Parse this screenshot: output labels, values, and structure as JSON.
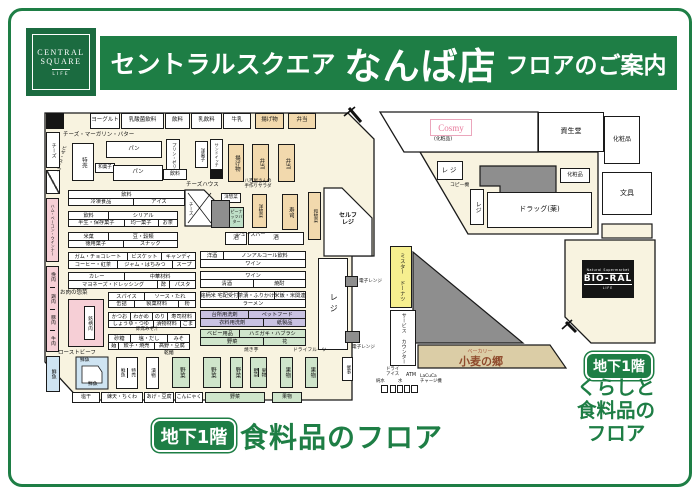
{
  "colors": {
    "brand_green": "#1e7e45",
    "floor_beige": "#f8f3e0",
    "deli_tan": "#f2d9ad",
    "meat_pink": "#f6cfd6",
    "fish_blue": "#cfe4f2",
    "produce_green": "#cfe5cb",
    "daily_purple": "#c9c2e2",
    "donut_yellow": "#f6ef8f"
  },
  "header": {
    "logo": {
      "line1": "CENTRAL",
      "line2": "SQUARE",
      "line3": "LIFE"
    },
    "title_store": "セントラルスクエア",
    "title_name": "なんば店",
    "title_suffix": "フロアのご案内"
  },
  "map": {
    "top_wall": [
      "ヨーグルト",
      "乳酸菌飲料",
      "飲料",
      "乳飲料",
      "牛乳",
      "揚げ物",
      "弁当"
    ],
    "dairy_label": "チーズ・マーガリン・バター",
    "left_wall": {
      "cheese": "チーズ",
      "pizza_soup": "ピザ・スープ",
      "ham": "ハム・ベーコン・ウインナー",
      "meat": [
        "挽肉",
        "鶏肉",
        "豚肉",
        "牛肉"
      ],
      "fish": "鮮魚"
    },
    "upper": {
      "tokubai": "特売",
      "pan1": "パン",
      "wagashi": "和菓子",
      "pan2": "パン",
      "purin": "プリン・ゼリー",
      "drink": "飲料",
      "yogashi": "洋菓子",
      "sandwich": "サンドイッチ",
      "agemono": "揚げ物",
      "bento1": "弁当",
      "bento2": "弁当"
    },
    "deli": {
      "cheese_house": "チーズハウス",
      "cheese": "チーズ",
      "salad": "八百屋さんの\n手作りサラダ",
      "yososai_small": "洋惣菜",
      "peanut": "ピーナッツバター",
      "juice_bar": "ジュースバー",
      "yososai": "洋惣菜",
      "sushi": "寿司",
      "wasozai": "和惣菜",
      "sake1": "酒",
      "sake2": "酒",
      "self_checkout": "セルフ\nレジ"
    },
    "shelves": [
      {
        "top": [
          "飲料"
        ],
        "bottom": [
          "冷凍食品",
          "アイス"
        ]
      },
      {
        "top": [
          "飲料",
          "シリアル"
        ],
        "bottom": [
          "半生・保存菓子",
          "均一菓子",
          "お茶"
        ]
      },
      {
        "top": [
          "米菓",
          "豆・穀類"
        ],
        "bottom": [
          "徳用菓子",
          "スナック"
        ]
      },
      {
        "top": [
          "ガム・チョコレート",
          "ビスケット",
          "キャンディ"
        ],
        "bottom": [
          "コーヒー・紅茶",
          "ジャム・はちみつ",
          "スープ"
        ]
      },
      {
        "top": [
          "カレー",
          "中華材料"
        ],
        "bottom": [
          "マヨネーズ・ドレッシング",
          "酢",
          "パスタ"
        ]
      },
      {
        "top": [
          "スパイス",
          "ソース・たれ"
        ],
        "bottom": [
          "缶詰",
          "製菓材料",
          "粉"
        ]
      },
      {
        "top": [
          "かつお",
          "わかめ",
          "のり",
          "寿司材料"
        ],
        "bottom": [
          "しょうゆ・つゆ",
          "漬物材料",
          "ごま"
        ]
      },
      {
        "top": [
          "砂糖",
          "塩・だし",
          "みそ"
        ],
        "bottom": [
          "麺",
          "餃子・焼売",
          "高野・豆腐"
        ]
      },
      {
        "top": [
          "洋酒",
          "ノンアルコール飲料"
        ],
        "bottom": [
          "ワイン"
        ]
      },
      {
        "top": [
          "ワイン"
        ],
        "bottom": [
          "清酒",
          "焼酎"
        ]
      },
      {
        "top": [
          "銘柄米 宅配受付",
          "茶漬・ふりかけ",
          "米飯・米関連"
        ],
        "bottom": [
          "ラーメン"
        ]
      },
      {
        "top": [
          "台所用洗剤",
          "ペットフード"
        ],
        "bottom": [
          "衣料用洗剤",
          "紙製品"
        ]
      },
      {
        "top": [
          "ベビー用品",
          "ハミガキ・ハブラシ"
        ],
        "bottom": [
          "野菜",
          "花"
        ]
      }
    ],
    "labels": {
      "misoshiru": "即席みそ汁",
      "kanmen": "乾麺",
      "yakiimo": "焼き芋",
      "dried_fruit": "ドライフルーツ",
      "meat_deli": "お肉の惣菜",
      "roast_beef": "ローストビーフ",
      "microwave": "電子レンジ",
      "copy": "コピー機"
    },
    "meat_brand": "銘柄肉",
    "checkout": "レジ",
    "saiji": "催事",
    "fish": {
      "big_top": "鮮魚",
      "big_bottom": "鮮魚",
      "pair1": "鮮魚",
      "pair2": "特売",
      "tsukemono": "漬物"
    },
    "produce": [
      "野菜",
      "野菜",
      "野菜",
      "野菜",
      "果物",
      "果物",
      "果物"
    ],
    "bottom_wall": [
      "塩干",
      "練天・ちくわ",
      "あげ・豆腐",
      "こんにゃく",
      "野菜",
      "果物"
    ],
    "machines": {
      "dry_ice": "ドライ\nアイス",
      "junsui": "純水",
      "mizu": "水",
      "atm": "ATM",
      "lacuca": "LaCuCa\nチャージ機"
    },
    "tenants": {
      "donut": "ミスター\nドーナツ",
      "service": "サービス\nカウンター",
      "bakery_label": "ベーカリー",
      "bakery_name": "小麦の郷",
      "cosmy": "Cosmy",
      "cosmy_sub": "(化粧品)",
      "bioral_top": "Natural Supermarket",
      "bioral": "BIO-RAL",
      "bioral_sub": "LIFE"
    },
    "right": {
      "shiseido": "資生堂",
      "cosmetics_side": "化粧品",
      "stationery": "文具",
      "regi1": "レジ",
      "cosmetics_small": "化粧品",
      "regi2": "レジ",
      "drug": "ドラッグ(薬)"
    }
  },
  "footer_center": {
    "level": "地下1階",
    "label": "食料品のフロア"
  },
  "footer_right": {
    "level": "地下1階",
    "text": "くらしと\n食料品の\nフロア"
  }
}
